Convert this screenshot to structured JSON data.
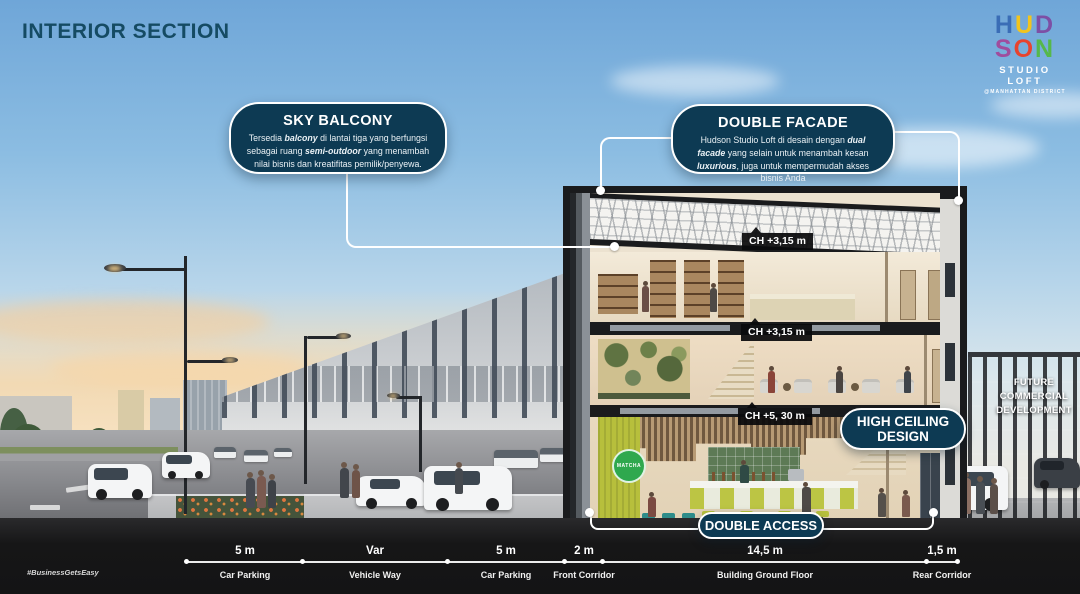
{
  "page": {
    "title": "INTERIOR SECTION",
    "hashtag": "#BusinessGetsEasy"
  },
  "logo": {
    "letters": [
      {
        "ch": "H",
        "color": "#3a6db6"
      },
      {
        "ch": "U",
        "color": "#f2c41d"
      },
      {
        "ch": "D",
        "color": "#7d4fa5"
      },
      {
        "ch": "S",
        "color": "#a04d9d"
      },
      {
        "ch": "O",
        "color": "#e8432e"
      },
      {
        "ch": "N",
        "color": "#56b84a"
      }
    ],
    "name": "STUDIO LOFT",
    "district": "@MANHATTAN DISTRICT"
  },
  "callouts": {
    "sky_balcony": {
      "title": "SKY BALCONY",
      "p1": "Tersedia ",
      "p2": "balcony",
      "p3": " di lantai tiga yang berfungsi sebagai ruang ",
      "p4": "semi-outdoor",
      "p5": " yang menambah nilai bisnis dan kreatifitas pemilik/penyewa."
    },
    "double_facade": {
      "title": "DOUBLE FACADE",
      "p1": "Hudson Studio Loft di desain dengan ",
      "p2": "dual facade",
      "p3": " yang selain untuk menambah kesan ",
      "p4": "luxurious",
      "p5": ", juga untuk mempermudah akses bisnis Anda"
    }
  },
  "section_labels": {
    "ch_labels": [
      {
        "text": "CH +3,15 m"
      },
      {
        "text": "CH +3,15 m"
      },
      {
        "text": "CH +5, 30 m"
      }
    ]
  },
  "badges": {
    "high_ceiling": "HIGH CEILING DESIGN",
    "double_access": "DOUBLE ACCESS"
  },
  "future_development": "FUTURE COMMERCIAL DEVELOPMENT",
  "cafe_sign": "MATCHA",
  "dimensions": {
    "segments": [
      {
        "value": "5 m",
        "label": "Car Parking"
      },
      {
        "value": "Var",
        "label": "Vehicle Way"
      },
      {
        "value": "5 m",
        "label": "Car Parking"
      },
      {
        "value": "2 m",
        "label": "Front Corridor"
      },
      {
        "value": "14,5 m",
        "label": "Building Ground Floor"
      },
      {
        "value": "1,5 m",
        "label": "Rear Corridor"
      }
    ]
  },
  "colors": {
    "navy": "#0d3a53",
    "title": "#154b63",
    "label_bg": "#0a0a0c"
  }
}
